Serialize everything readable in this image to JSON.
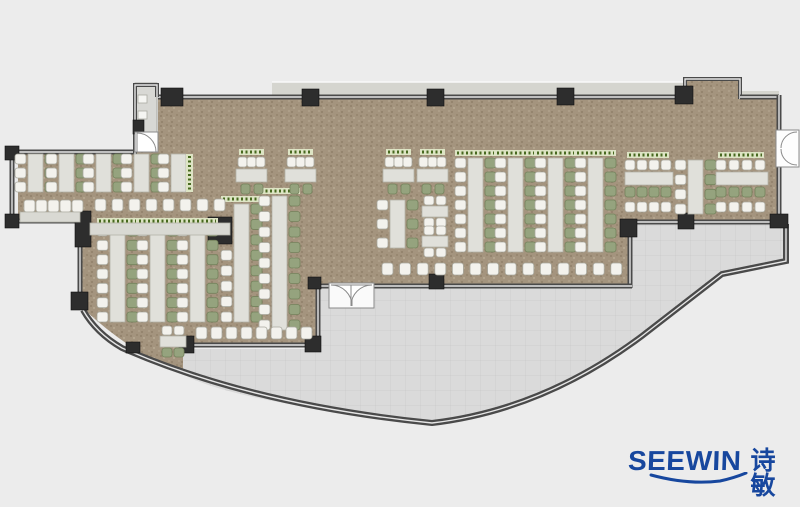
{
  "page": {
    "background": "#ececec",
    "width": 800,
    "height": 507
  },
  "logo": {
    "brand": "SEEWIN",
    "cjk": "诗敏",
    "color": "#17479e"
  },
  "palette": {
    "floor": "#a4947e",
    "speck_dark1": "#8b7c66",
    "speck_dark2": "#8f8069",
    "speck_light1": "#bdb09a",
    "speck_light2": "#b3a58f",
    "terrace": "#dadada",
    "terrace_line": "#c9c9c9",
    "wall": "#4a4a4a",
    "wall_light": "#e6e6e6",
    "column": "#2d2d2d",
    "band": "#d5d5cf",
    "vestibule": "#d8d8d4",
    "table": "#e0e0da",
    "table_border": "#b2b2a8",
    "counter": "#d9d9d3",
    "chair_white": "#f3f2ed",
    "chair_white_border": "#a9a99f",
    "chair_green": "#95a37e",
    "chair_green_border": "#74825c",
    "planter_bg": "#dde4c4",
    "planter_dot": "#47691f",
    "door_fill": "#fdfdfd",
    "door_stroke": "#8a8a8a"
  },
  "plan": {
    "dining_path": "M158,95 L685,95 L685,79 L740,79 L740,95 L779,95 L779,224 L630,224 L630,287 L318,287 L318,346 L183,346 L183,374 Q130,352 86,311 L80,280 L80,221 L18,221 L18,152 L133,152 L133,133 L158,133 Z",
    "terrace_path": "M318,287 L630,287 L630,224 L786,224 L786,261 L722,274 L642,336 Q543,410 432,423 Q252,405 190,378 L183,374 L183,349 L318,349 Z",
    "extras": [
      {
        "x": 272,
        "y": 82,
        "w": 413,
        "h": 13,
        "f": "#d5d5cf"
      },
      {
        "x": 740,
        "y": 91,
        "w": 39,
        "h": 6,
        "f": "#d5d5cf"
      },
      {
        "x": 135,
        "y": 83,
        "w": 22,
        "h": 49,
        "f": "#d8d8d4",
        "s": "#9b9b95"
      },
      {
        "x": 138,
        "y": 95,
        "w": 9,
        "h": 8,
        "f": "#f5f5f2",
        "s": "#aaaaa2"
      },
      {
        "x": 138,
        "y": 111,
        "w": 9,
        "h": 8,
        "f": "#f5f5f2",
        "s": "#aaaaa2"
      }
    ],
    "extra_lines": [
      {
        "d": "M272,82 L685,82",
        "s": "#fafafa",
        "w": 1.5
      }
    ],
    "walls": [
      {
        "d": "M158,97 L685,97",
        "w": 5
      },
      {
        "d": "M685,99 L685,79 L740,79 L740,99",
        "w": 4
      },
      {
        "d": "M740,97 L779,97",
        "w": 5
      },
      {
        "d": "M779,95 L779,131",
        "w": 5
      },
      {
        "d": "M779,165 L779,224",
        "w": 5
      },
      {
        "d": "M781,222 L630,222",
        "w": 5
      },
      {
        "d": "M630,220 L630,288",
        "w": 5
      },
      {
        "d": "M632,286 L374,286",
        "w": 5
      },
      {
        "d": "M331,286 L316,286",
        "w": 5
      },
      {
        "d": "M318,284 L318,347",
        "w": 5
      },
      {
        "d": "M320,345 L181,345",
        "w": 5
      },
      {
        "d": "M18,221 L80,221",
        "w": 5
      },
      {
        "d": "M80,219 L80,310",
        "w": 5
      },
      {
        "d": "M12,223 L12,150",
        "w": 5
      },
      {
        "d": "M12,152 L135,152",
        "w": 5
      },
      {
        "d": "M135,154 L135,85 L157,85 L157,97",
        "w": 4
      },
      {
        "d": "M90,232 L210,232",
        "w": 4
      },
      {
        "d": "M83,310 Q96,333 122,348 Q252,405 432,423 Q543,410 642,336 L722,274 L786,261 L786,224",
        "w": 6
      }
    ],
    "columns": [
      {
        "x": 5,
        "y": 146,
        "w": 14,
        "h": 14
      },
      {
        "x": 5,
        "y": 214,
        "w": 14,
        "h": 14
      },
      {
        "x": 75,
        "y": 211,
        "w": 16,
        "h": 36
      },
      {
        "x": 208,
        "y": 217,
        "w": 24,
        "h": 27
      },
      {
        "x": 71,
        "y": 292,
        "w": 17,
        "h": 18
      },
      {
        "x": 126,
        "y": 342,
        "w": 14,
        "h": 11
      },
      {
        "x": 133,
        "y": 120,
        "w": 11,
        "h": 14
      },
      {
        "x": 161,
        "y": 88,
        "w": 22,
        "h": 18
      },
      {
        "x": 302,
        "y": 89,
        "w": 17,
        "h": 17
      },
      {
        "x": 427,
        "y": 89,
        "w": 17,
        "h": 17
      },
      {
        "x": 557,
        "y": 88,
        "w": 17,
        "h": 17
      },
      {
        "x": 675,
        "y": 86,
        "w": 18,
        "h": 18
      },
      {
        "x": 770,
        "y": 214,
        "w": 18,
        "h": 14
      },
      {
        "x": 678,
        "y": 213,
        "w": 16,
        "h": 16
      },
      {
        "x": 620,
        "y": 219,
        "w": 17,
        "h": 18
      },
      {
        "x": 429,
        "y": 274,
        "w": 15,
        "h": 15
      },
      {
        "x": 308,
        "y": 277,
        "w": 13,
        "h": 12
      },
      {
        "x": 305,
        "y": 336,
        "w": 16,
        "h": 16
      },
      {
        "x": 179,
        "y": 336,
        "w": 15,
        "h": 17
      }
    ],
    "doors": [
      {
        "d": "M135,132 L158,132 L158,152 L135,152 Z",
        "f": "#fdfdfd"
      },
      {
        "d": "M137,133 A19,19 0 0 1 156,152 L137,152 Z",
        "f": "#ffffff"
      },
      {
        "d": "M329,283 L374,283 L374,308 L329,308 Z",
        "f": "#fafafa"
      },
      {
        "d": "M331,285 A21,21 0 0 1 352,306 L352,285 Z",
        "f": "#ffffff"
      },
      {
        "d": "M372,285 A21,21 0 0 0 351,306 L351,285 Z",
        "f": "#ffffff"
      },
      {
        "d": "M776,130 L799,130 L799,167 L776,167 Z",
        "f": "#fdfdfd"
      },
      {
        "d": "M797,132 A16,16 0 0 0 781,148",
        "f": "none"
      },
      {
        "d": "M797,165 A16,16 0 0 1 781,149",
        "f": "none"
      }
    ],
    "furniture": {
      "vtables": [
        {
          "x": 28,
          "y": 154,
          "h": 38,
          "n": 3,
          "l": "w",
          "r": "g"
        },
        {
          "x": 59,
          "y": 154,
          "h": 38,
          "n": 3,
          "l": "w",
          "r": "g"
        },
        {
          "x": 96,
          "y": 154,
          "h": 38,
          "n": 3,
          "l": "w",
          "r": "g"
        },
        {
          "x": 134,
          "y": 154,
          "h": 38,
          "n": 3,
          "l": "w",
          "r": "g"
        },
        {
          "x": 171,
          "y": 154,
          "h": 38,
          "n": 3,
          "l": "w",
          "r": "n"
        },
        {
          "x": 110,
          "y": 226,
          "h": 96,
          "n": 7,
          "l": "w",
          "r": "g",
          "pt": 1
        },
        {
          "x": 150,
          "y": 226,
          "h": 96,
          "n": 7,
          "l": "w",
          "r": "g",
          "pt": 1
        },
        {
          "x": 190,
          "y": 226,
          "h": 96,
          "n": 7,
          "l": "w",
          "r": "g",
          "pt": 1
        },
        {
          "x": 234,
          "y": 204,
          "h": 118,
          "n": 8,
          "l": "w",
          "r": "g",
          "pt": 1,
          "ls": 44
        },
        {
          "x": 272,
          "y": 196,
          "h": 134,
          "n": 9,
          "l": "w",
          "r": "g",
          "pt": 1
        },
        {
          "x": 390,
          "y": 200,
          "h": 48,
          "n": 3,
          "l": "w",
          "r": "g"
        },
        {
          "x": 468,
          "y": 158,
          "h": 94,
          "n": 7,
          "l": "w",
          "r": "g",
          "pt": 1
        },
        {
          "x": 508,
          "y": 158,
          "h": 94,
          "n": 7,
          "l": "w",
          "r": "g",
          "pt": 1
        },
        {
          "x": 548,
          "y": 158,
          "h": 94,
          "n": 7,
          "l": "w",
          "r": "g",
          "pt": 1
        },
        {
          "x": 588,
          "y": 158,
          "h": 94,
          "n": 7,
          "l": "w",
          "r": "g",
          "pt": 1
        },
        {
          "x": 688,
          "y": 160,
          "h": 54,
          "n": 4,
          "l": "w",
          "r": "g"
        }
      ],
      "hclusters": [
        {
          "x": 238,
          "y": 149
        },
        {
          "x": 287,
          "y": 149
        },
        {
          "x": 385,
          "y": 149
        },
        {
          "x": 419,
          "y": 149
        }
      ],
      "rclusters": [
        {
          "x": 625,
          "y": 152,
          "w": 48
        },
        {
          "x": 716,
          "y": 152,
          "w": 52
        }
      ],
      "sets": [
        {
          "x": 422,
          "y": 196,
          "b": "w"
        },
        {
          "x": 422,
          "y": 226,
          "b": "w"
        },
        {
          "x": 160,
          "y": 326,
          "b": "g"
        }
      ],
      "rows": [
        {
          "x": 24,
          "y": 200,
          "n": 5,
          "p": 12
        },
        {
          "x": 95,
          "y": 199,
          "n": 8,
          "p": 17
        },
        {
          "x": 196,
          "y": 327,
          "n": 8,
          "p": 15
        },
        {
          "x": 382,
          "y": 263,
          "n": 14,
          "p": 17.6
        }
      ],
      "counters": [
        {
          "x": 20,
          "y": 212,
          "w": 60,
          "h": 10
        },
        {
          "x": 90,
          "y": 223,
          "w": 140,
          "h": 12
        }
      ],
      "vplanters": [
        {
          "x": 186,
          "y": 154,
          "h": 38
        }
      ]
    }
  }
}
